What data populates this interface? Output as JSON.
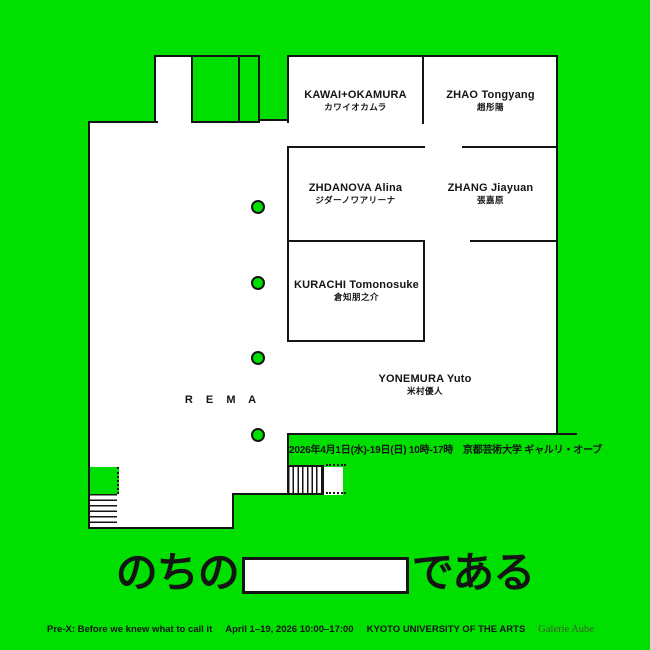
{
  "poster": {
    "bg_color": "#00DF00",
    "ink_color": "#141414"
  },
  "floorplan": {
    "rooms": [
      {
        "name_en": "KAWAI+OKAMURA",
        "name_ja": "カワイオカムラ"
      },
      {
        "name_en": "ZHAO Tongyang",
        "name_ja": "趙彤陽"
      },
      {
        "name_en": "ZHDANOVA Alina",
        "name_ja": "ジダーノワアリーナ"
      },
      {
        "name_en": "ZHANG Jiayuan",
        "name_ja": "張嘉原"
      },
      {
        "name_en": "KURACHI Tomonosuke",
        "name_ja": "倉知朋之介"
      },
      {
        "name_en": "YONEMURA Yuto",
        "name_ja": "米村優人"
      }
    ],
    "rema_label": "R E M A",
    "date_line": "2026年4月1日(水)-19日(日) 10時-17時　京都芸術大学 ギャルリ・オーブ"
  },
  "tagline": {
    "before": "のちの",
    "after": "である"
  },
  "footer": {
    "title_en": "Pre-X: Before we knew what to call it",
    "dates_en": "April 1–19, 2026 10:00–17:00",
    "venue_en": "KYOTO UNIVERSITY OF THE ARTS",
    "gallery": "Galerie Aube"
  }
}
